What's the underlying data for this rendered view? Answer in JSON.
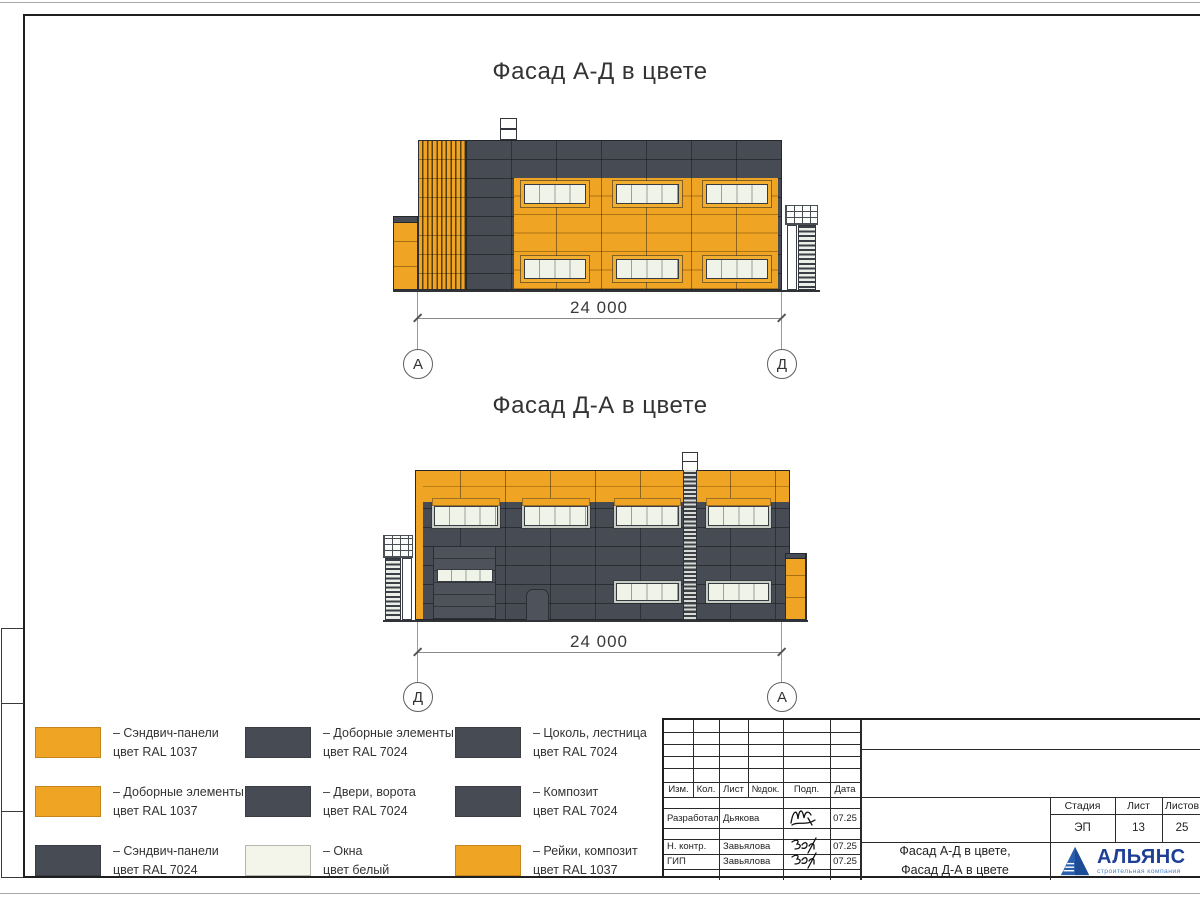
{
  "colors": {
    "orange": "#F0A423",
    "dark_gray": "#474B53",
    "window_white": "#F0F3E8",
    "logo_blue": "#1E3F96",
    "logo_light_blue": "#4E86CB"
  },
  "facades": [
    {
      "title": "Фасад А-Д в цвете",
      "dimension": "24 000",
      "axis_left": "А",
      "axis_right": "Д"
    },
    {
      "title": "Фасад Д-А в цвете",
      "dimension": "24 000",
      "axis_left": "Д",
      "axis_right": "А"
    }
  ],
  "legend": {
    "items": [
      {
        "swatch": "#F0A423",
        "line1": "– Сэндвич-панели",
        "line2": "цвет RAL 1037"
      },
      {
        "swatch": "#F0A423",
        "line1": "– Доборные элементы",
        "line2": "цвет RAL 1037"
      },
      {
        "swatch": "#474B53",
        "line1": "– Сэндвич-панели",
        "line2": "цвет RAL 7024"
      },
      {
        "swatch": "#474B53",
        "line1": "– Доборные элементы",
        "line2": "цвет RAL 7024"
      },
      {
        "swatch": "#474B53",
        "line1": "– Двери, ворота",
        "line2": "цвет RAL 7024"
      },
      {
        "swatch": "#F3F5EA",
        "line1": "– Окна",
        "line2": "цвет белый"
      },
      {
        "swatch": "#474B53",
        "line1": "– Цоколь, лестница",
        "line2": "цвет RAL 7024"
      },
      {
        "swatch": "#474B53",
        "line1": "– Композит",
        "line2": "цвет RAL 7024"
      },
      {
        "swatch": "#F0A423",
        "line1": "– Рейки, композит",
        "line2": "цвет RAL 1037"
      }
    ]
  },
  "title_block": {
    "header_cells": [
      "Изм.",
      "Кол.",
      "Лист",
      "№док.",
      "Подп.",
      "Дата"
    ],
    "rows": [
      {
        "role": "Разработал",
        "name": "Дьякова",
        "date": "07.25"
      },
      {
        "role": "Н. контр.",
        "name": "Завьялова",
        "date": "07.25"
      },
      {
        "role": "ГИП",
        "name": "Завьялова",
        "date": "07.25"
      }
    ],
    "doc_title_line1": "Фасад А-Д в цвете,",
    "doc_title_line2": "Фасад Д-А в цвете",
    "stage_label": "Стадия",
    "sheet_label": "Лист",
    "sheets_label": "Листов",
    "stage_value": "ЭП",
    "sheet_value": "13",
    "sheets_value": "25",
    "logo_name": "АЛЬЯНС",
    "logo_subtitle": "строительная компания"
  }
}
